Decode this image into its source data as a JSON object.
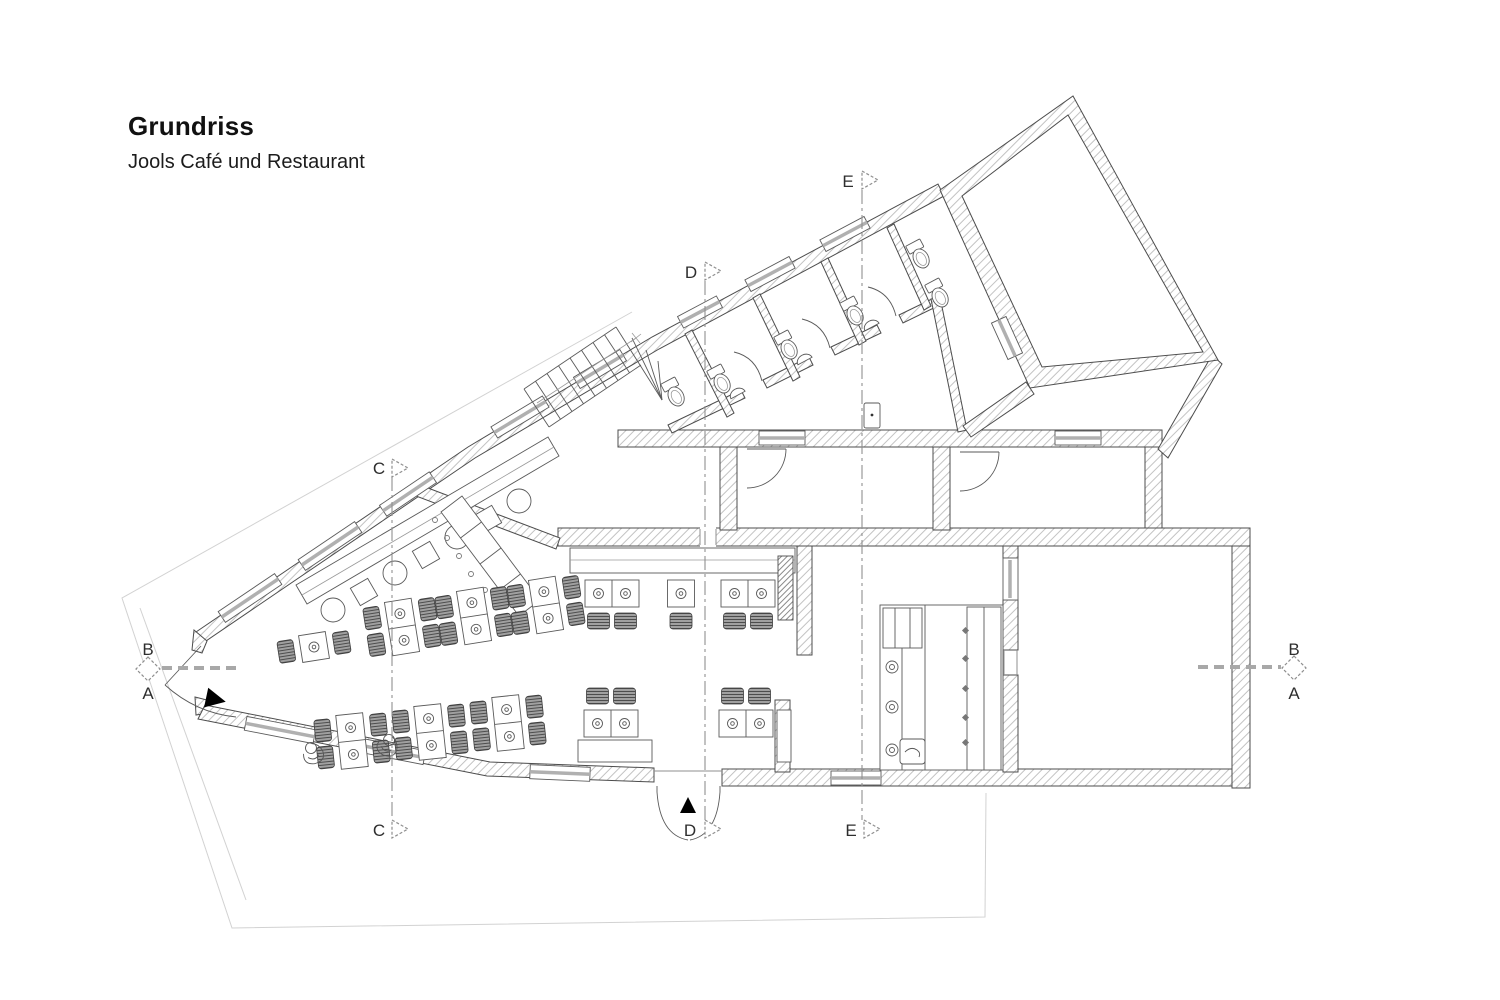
{
  "title": {
    "heading": "Grundriss",
    "subheading": "Jools Café und Restaurant"
  },
  "section_markers": {
    "ab_left": {
      "top": "B",
      "bottom": "A"
    },
    "ab_right": {
      "top": "B",
      "bottom": "A"
    },
    "c": {
      "top": "C",
      "bottom": "C"
    },
    "d": {
      "top": "D",
      "bottom": "D"
    },
    "e": {
      "top": "E",
      "bottom": "E"
    }
  },
  "colors": {
    "background": "#ffffff",
    "wall_outline": "#4c4c4c",
    "wall_hatch": "#c3c3c3",
    "section_line": "#8f8f8f",
    "ab_dash_line": "#a8a8a8",
    "chair_fill": "#a0a0a0",
    "site_outline": "#d2d2d2",
    "text": "#1a1a1a"
  }
}
